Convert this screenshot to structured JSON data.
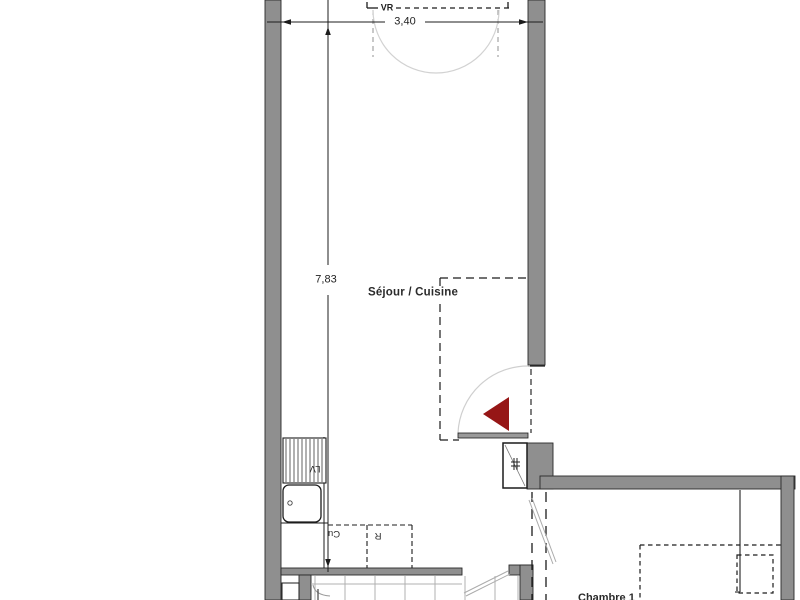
{
  "plan": {
    "rooms": [
      {
        "id": "sejour-cuisine",
        "label": "Séjour / Cuisine"
      },
      {
        "id": "chambre-1",
        "label": "Chambre 1"
      }
    ],
    "dimensions": [
      {
        "id": "width",
        "value": "3,40"
      },
      {
        "id": "height",
        "value": "7,83"
      }
    ],
    "annotations": {
      "shutter": "VR",
      "dishwasher": "LV",
      "cooker": "Cu",
      "fridge": "R"
    },
    "colors": {
      "wall": "#8f8f8f",
      "entrance_arrow": "#961616",
      "line": "#1c1c1c"
    }
  }
}
